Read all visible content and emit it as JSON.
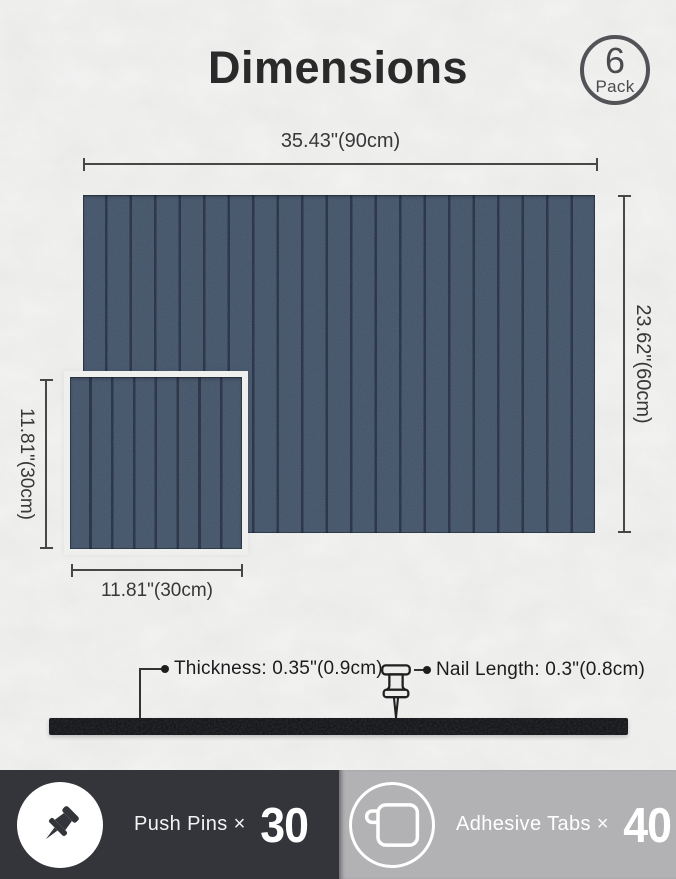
{
  "page": {
    "title": "Dimensions"
  },
  "pack_badge": {
    "count": "6",
    "label": "Pack"
  },
  "panels": {
    "large": {
      "width_label": "35.43\"(90cm)",
      "height_label": "23.62\"(60cm)"
    },
    "small": {
      "height_label": "11.81\"(30cm)",
      "width_label": "11.81\"(30cm)"
    }
  },
  "side_view": {
    "thickness_label": "Thickness: 0.35\"(0.9cm)",
    "nail_label": "Nail Length: 0.3\"(0.8cm)"
  },
  "footer": {
    "push_pins": {
      "icon": "push-pin-icon",
      "label": "Push Pins ×",
      "count": "30"
    },
    "adhesive_tabs": {
      "icon": "adhesive-tab-icon",
      "label": "Adhesive Tabs ×",
      "count": "40"
    }
  },
  "colors": {
    "bg": "#eaebe9",
    "panel": "#46566b",
    "groove": "#2a3447",
    "gap": "#eff0ee",
    "bar": "#15171a",
    "line": "#474747",
    "text": "#2b2b2b",
    "title": "#2a2a2a",
    "badge": "#4b4b4f",
    "footer_dark": "#33353a",
    "footer_gray": "#b2b2b4"
  }
}
